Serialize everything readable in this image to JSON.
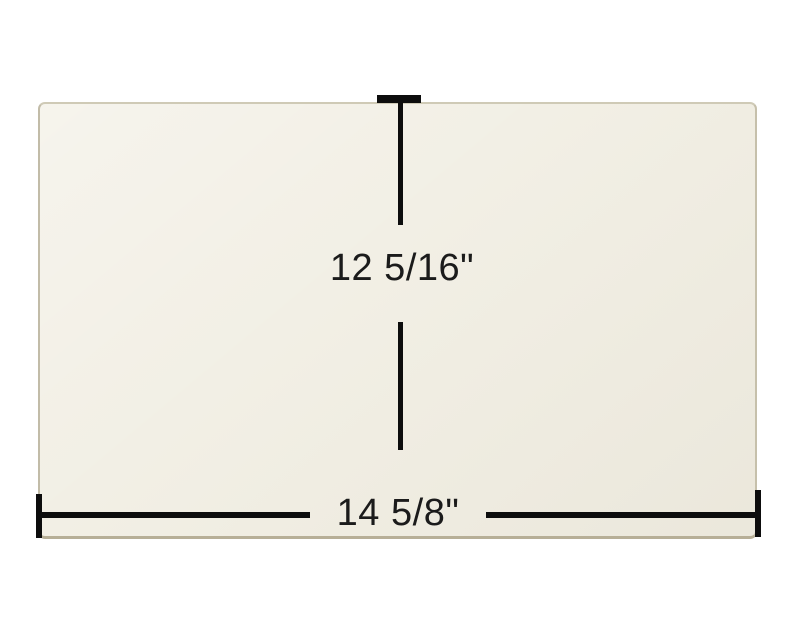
{
  "diagram": {
    "height_dimension": {
      "label": "12 5/16\""
    },
    "width_dimension": {
      "label": "14 5/8\""
    },
    "colors": {
      "background": "#ffffff",
      "panel_fill": "#f1eee3",
      "panel_edge": "#c6c0ab",
      "dimension_line": "#0d0d0d",
      "label_text": "#1b1b1b"
    }
  }
}
